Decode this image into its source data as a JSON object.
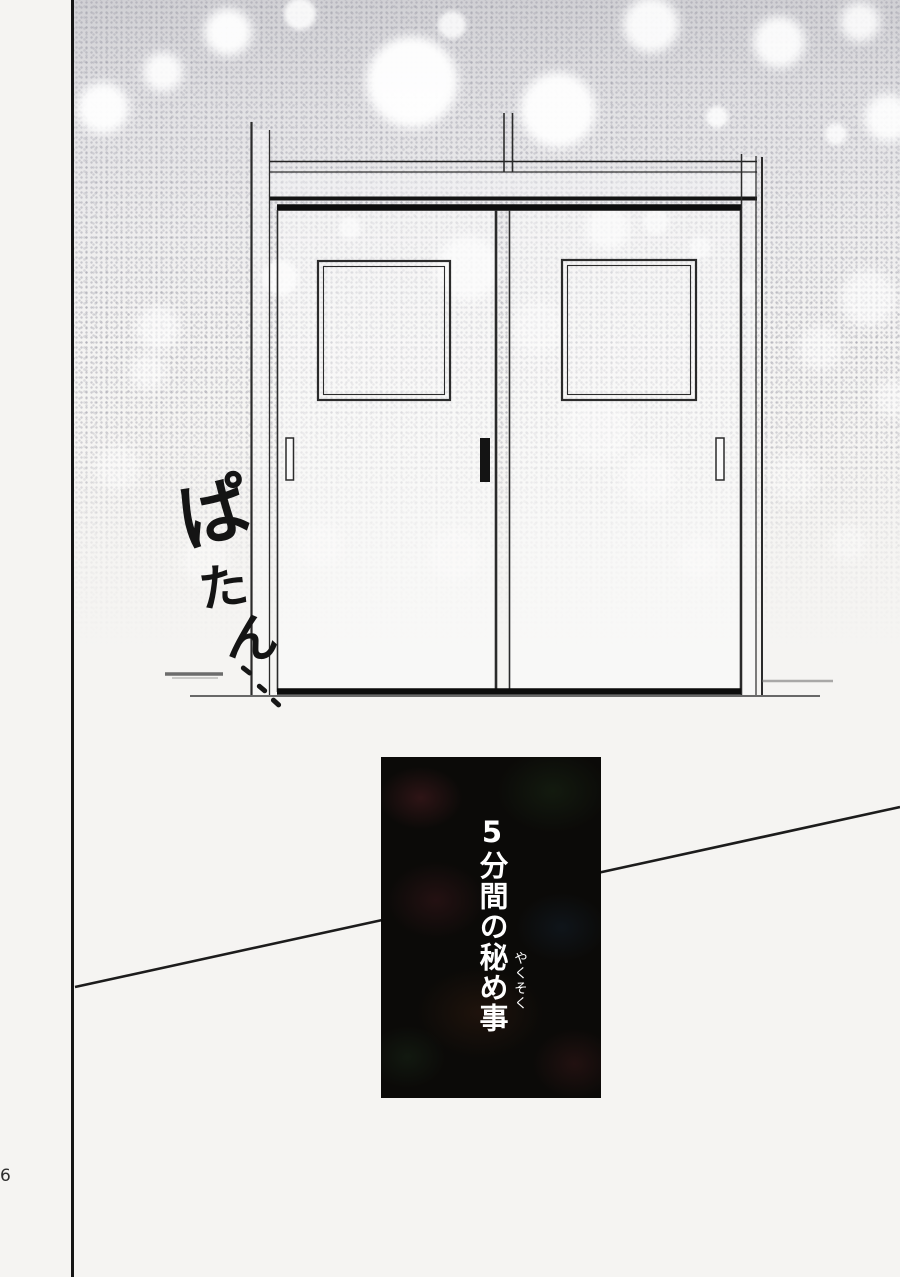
{
  "page": {
    "number": "6",
    "background_color": "#f5f4f2",
    "ink_color": "#1a1a1a",
    "texture": "gray halftone stipple with white bokeh circles, fading to white near floor"
  },
  "scene": {
    "description": "closed double sliding doors with square windows, floor line below",
    "sfx": {
      "text": "ぱたん…",
      "chars": [
        "ぱ",
        "た",
        "ん"
      ],
      "meaning": "patan (soft sound of a door shutting)"
    }
  },
  "title_panel": {
    "text": "5分間の秘め事",
    "furigana": "やくそく",
    "text_color": "#ffffff",
    "background_color": "#0b0a08"
  }
}
